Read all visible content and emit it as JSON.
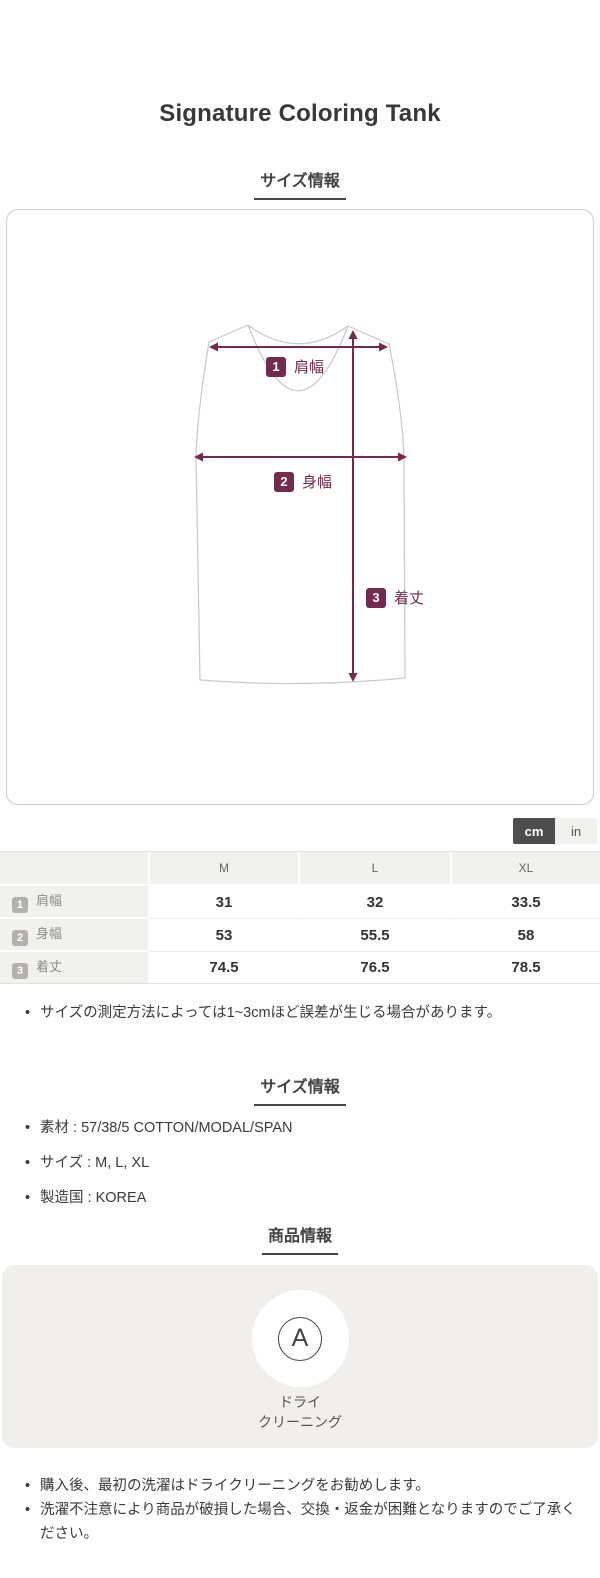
{
  "accent_color": "#76294f",
  "page": {
    "title": "Signature Coloring Tank"
  },
  "size_section": {
    "heading": "サイズ情報",
    "diagram": {
      "labels": [
        {
          "num": "1",
          "text": "肩幅"
        },
        {
          "num": "2",
          "text": "身幅"
        },
        {
          "num": "3",
          "text": "着丈"
        }
      ]
    },
    "unit_toggle": {
      "cm_label": "cm",
      "in_label": "in",
      "active": "cm"
    },
    "table": {
      "columns": [
        "M",
        "L",
        "XL"
      ],
      "rows": [
        {
          "num": "1",
          "label": "肩幅",
          "values": [
            "31",
            "32",
            "33.5"
          ]
        },
        {
          "num": "2",
          "label": "身幅",
          "values": [
            "53",
            "55.5",
            "58"
          ]
        },
        {
          "num": "3",
          "label": "着丈",
          "values": [
            "74.5",
            "76.5",
            "78.5"
          ]
        }
      ]
    },
    "note": "サイズの測定方法によっては1~3cmほど誤差が生じる場合があります。"
  },
  "spec_section": {
    "heading": "サイズ情報",
    "items": [
      "素材 : 57/38/5 COTTON/MODAL/SPAN",
      "サイズ : M, L, XL",
      "製造国 : KOREA"
    ]
  },
  "product_section": {
    "heading": "商品情報",
    "care": {
      "symbol": "A",
      "label_line1": "ドライ",
      "label_line2": "クリーニング"
    },
    "notes": [
      "購入後、最初の洗濯はドライクリーニングをお勧めします。",
      "洗濯不注意により商品が破損した場合、交換・返金が困難となりますのでご了承ください。"
    ]
  }
}
